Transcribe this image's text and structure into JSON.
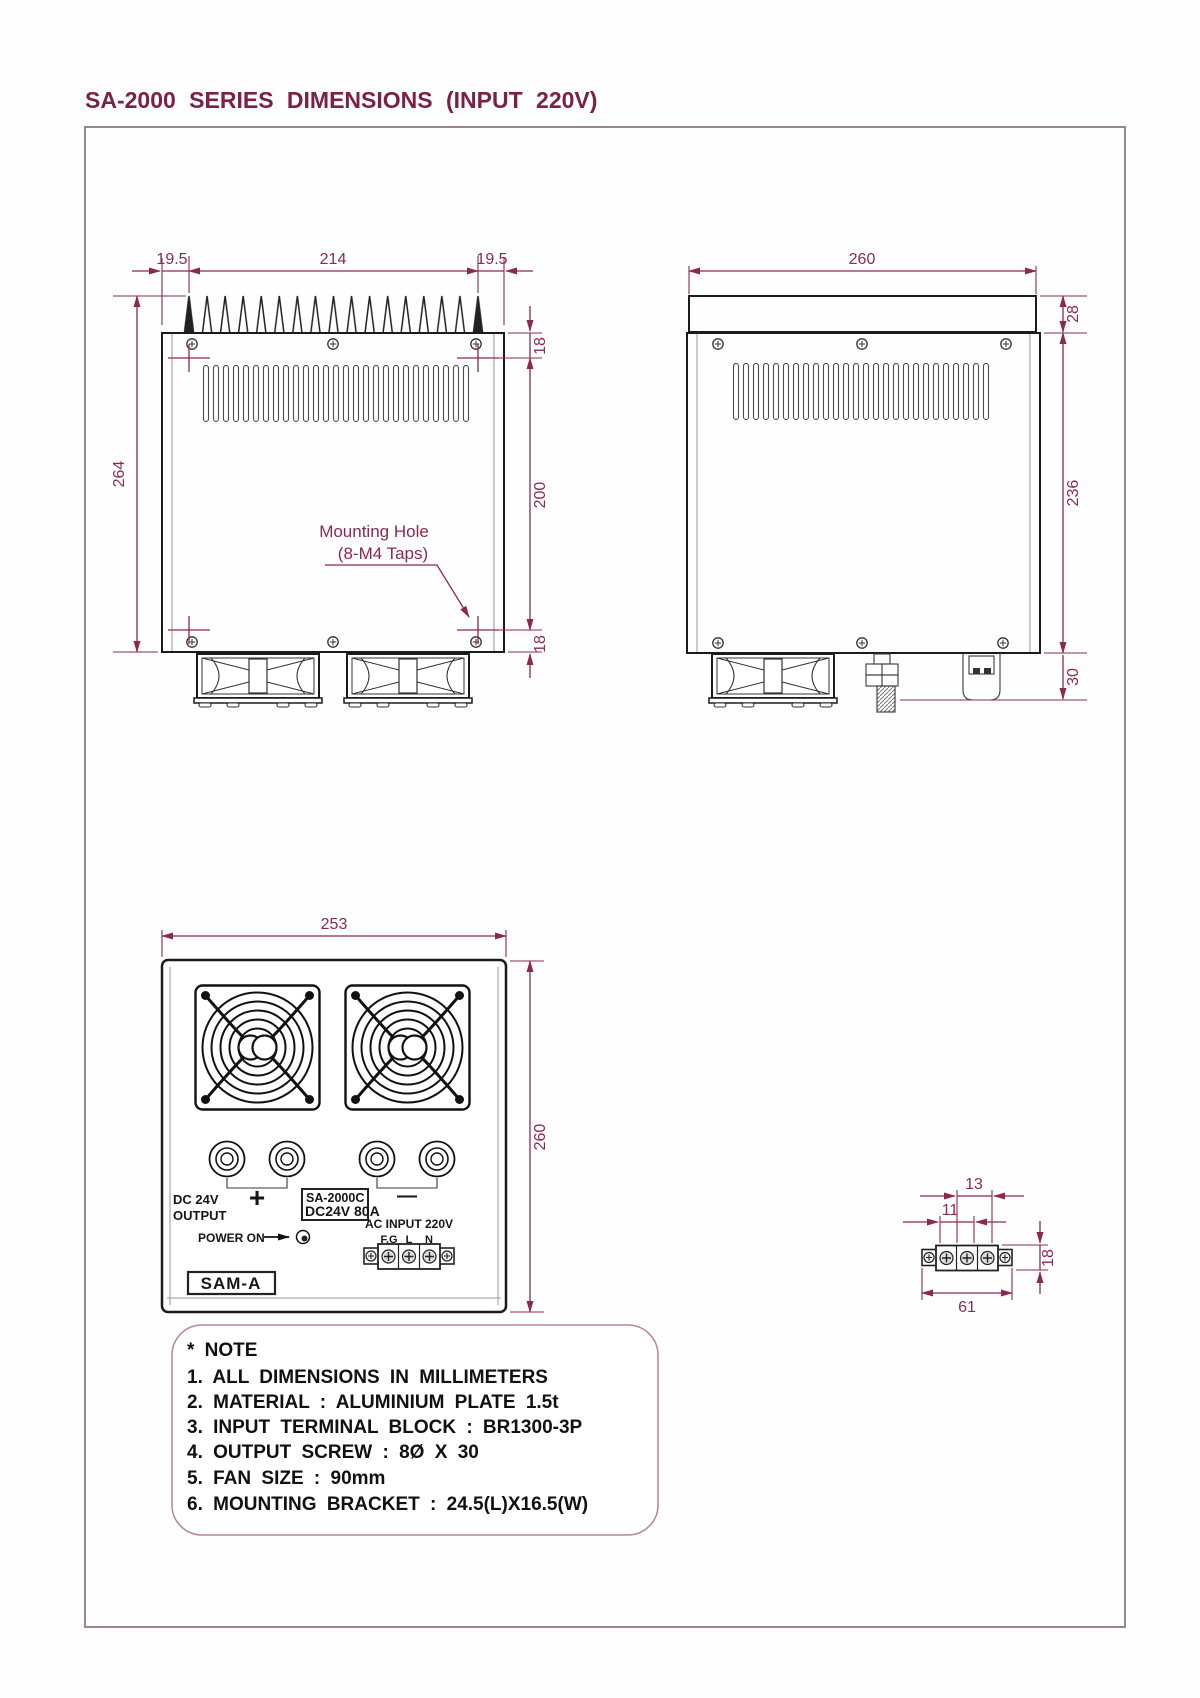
{
  "title": "SA-2000 SERIES DIMENSIONS (INPUT 220V)",
  "colors": {
    "dimension": "#8b2950",
    "title": "#7a2144",
    "drawing_line": "#1b1b1b",
    "frame_border": "#9b8391",
    "note_border": "#bb8399"
  },
  "top_view": {
    "dim_left_offset": "19.5",
    "dim_fin_span": "214",
    "dim_right_offset": "19.5",
    "dim_depth": "264",
    "dim_hole_inset_top": "18",
    "dim_hole_span": "200",
    "dim_hole_inset_bottom": "18",
    "callout_line1": "Mounting Hole",
    "callout_line2": "(8-M4 Taps)"
  },
  "side_view": {
    "dim_width": "260",
    "dim_heatsink_height": "28",
    "dim_body_height": "236",
    "dim_fan_height": "30"
  },
  "front_view": {
    "dim_width": "253",
    "dim_height": "260",
    "output_label_line1": "DC 24V",
    "output_label_line2": "OUTPUT",
    "plus": "+",
    "minus": "—",
    "model_line1": "SA-2000C",
    "model_line2": "DC24V 80A",
    "power_on": "POWER ON",
    "ac_input": "AC INPUT 220V",
    "terminal_fg": "F.G",
    "terminal_l": "L",
    "terminal_n": "N",
    "brand": "SAM-A"
  },
  "terminal_detail": {
    "dim_pitch_outer": "13",
    "dim_pitch_inner": "11",
    "dim_height": "18",
    "dim_length": "61"
  },
  "note": {
    "header": "* NOTE",
    "items": [
      "1. ALL DIMENSIONS IN MILLIMETERS",
      "2. MATERIAL : ALUMINIUM PLATE 1.5t",
      "3. INPUT TERMINAL BLOCK : BR1300-3P",
      "4. OUTPUT SCREW : 8Ø X 30",
      "5. FAN SIZE : 90mm",
      "6. MOUNTING BRACKET : 24.5(L)X16.5(W)"
    ]
  }
}
